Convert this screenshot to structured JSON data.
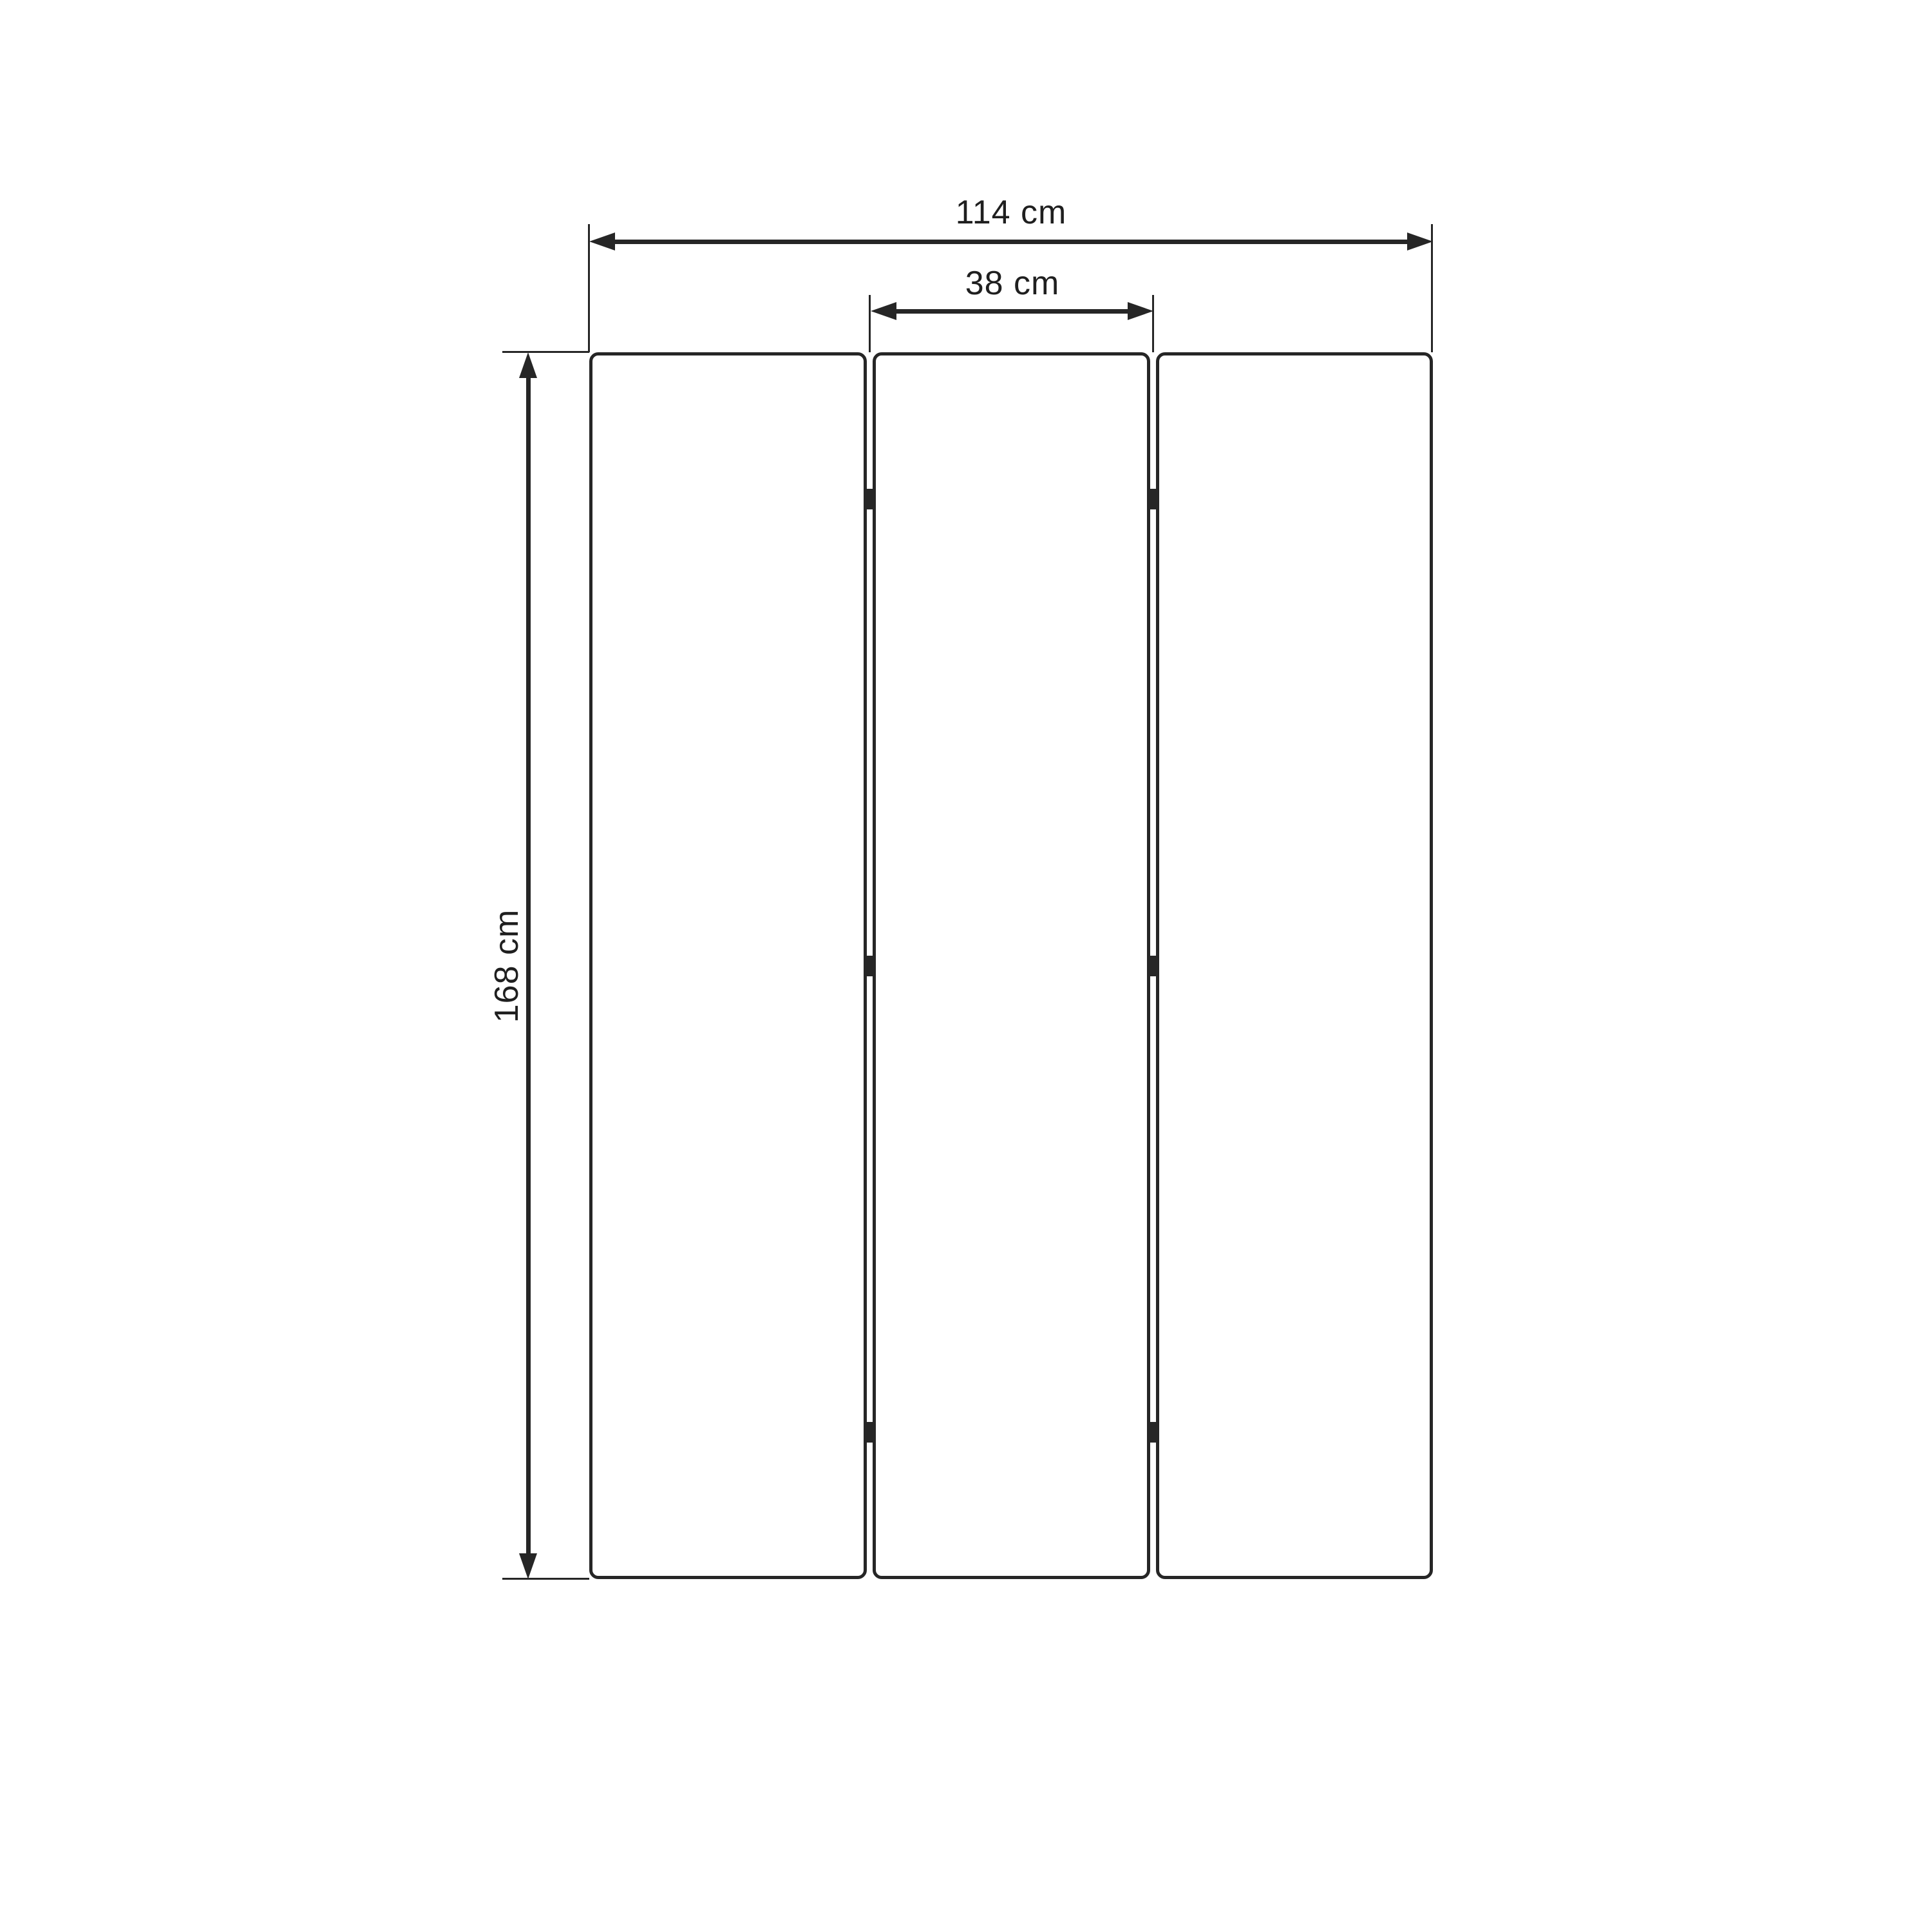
{
  "diagram": {
    "type": "technical-dimension-drawing",
    "subject": "three-panel folding screen, front view",
    "panel_count": 3,
    "dimensions": {
      "total_width": "114 cm",
      "single_panel_width": "38 cm",
      "height": "168 cm"
    }
  },
  "theme": {
    "line-color": "#262626",
    "text-color": "#1f1f1f",
    "bg-color": "#ffffff"
  }
}
